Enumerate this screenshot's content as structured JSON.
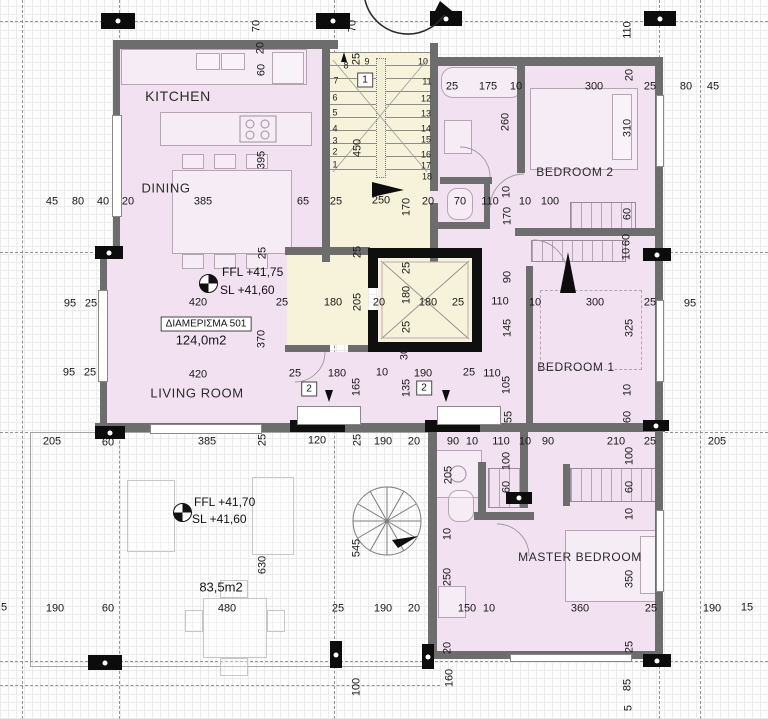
{
  "title": "Floor plan - Apartment 501",
  "colors": {
    "room_fill": "#f2e2f1",
    "stair_fill": "#f7f3da",
    "wall": "#6d6d6d",
    "black": "#0f0f0f",
    "dim_text": "#191919"
  },
  "apartment": {
    "tag": "ΔΙΑΜΕΡΙΣΜΑ 501",
    "area": "124,0m2",
    "ffl": "FFL +41,75",
    "sl": "SL  +41,60"
  },
  "terrace": {
    "area": "83,5m2",
    "ffl": "FFL +41,70",
    "sl": "SL  +41,60"
  },
  "rooms": [
    {
      "name": "KITCHEN",
      "x": 178,
      "y": 96,
      "size": 14
    },
    {
      "name": "DINING",
      "x": 166,
      "y": 188,
      "size": 13
    },
    {
      "name": "LIVING ROOM",
      "x": 197,
      "y": 393,
      "size": 13
    },
    {
      "name": "BEDROOM 2",
      "x": 575,
      "y": 172,
      "size": 12
    },
    {
      "name": "BEDROOM 1",
      "x": 576,
      "y": 367,
      "size": 12
    },
    {
      "name": "MASTER BEDROOM",
      "x": 580,
      "y": 557,
      "size": 12
    }
  ],
  "tags": [
    {
      "label": "1",
      "x": 365,
      "y": 80
    },
    {
      "label": "2",
      "x": 309,
      "y": 389
    },
    {
      "label": "2",
      "x": 424,
      "y": 388
    }
  ],
  "stair_steps": [
    {
      "n": "1",
      "x": 335,
      "y": 165
    },
    {
      "n": "2",
      "x": 335,
      "y": 152
    },
    {
      "n": "3",
      "x": 335,
      "y": 141
    },
    {
      "n": "4",
      "x": 335,
      "y": 129
    },
    {
      "n": "5",
      "x": 335,
      "y": 113
    },
    {
      "n": "6",
      "x": 335,
      "y": 98
    },
    {
      "n": "7",
      "x": 336,
      "y": 81
    },
    {
      "n": "8",
      "x": 346,
      "y": 66
    },
    {
      "n": "9",
      "x": 367,
      "y": 62
    },
    {
      "n": "10",
      "x": 423,
      "y": 62
    },
    {
      "n": "11",
      "x": 427,
      "y": 82
    },
    {
      "n": "12",
      "x": 426,
      "y": 99
    },
    {
      "n": "13",
      "x": 426,
      "y": 114
    },
    {
      "n": "14",
      "x": 426,
      "y": 129
    },
    {
      "n": "15",
      "x": 426,
      "y": 140
    },
    {
      "n": "16",
      "x": 426,
      "y": 155
    },
    {
      "n": "17",
      "x": 426,
      "y": 166
    },
    {
      "n": "18",
      "x": 427,
      "y": 177
    }
  ],
  "dimensions": [
    {
      "t": "70",
      "x": 257,
      "y": 26,
      "v": 1
    },
    {
      "t": "70",
      "x": 353,
      "y": 26,
      "v": 1
    },
    {
      "t": "110",
      "x": 628,
      "y": 30,
      "v": 1
    },
    {
      "t": "20",
      "x": 261,
      "y": 48,
      "v": 1
    },
    {
      "t": "60",
      "x": 262,
      "y": 70,
      "v": 1
    },
    {
      "t": "25",
      "x": 357,
      "y": 59,
      "v": 1
    },
    {
      "t": "450",
      "x": 358,
      "y": 148,
      "v": 1
    },
    {
      "t": "395",
      "x": 262,
      "y": 160,
      "v": 1
    },
    {
      "t": "25",
      "x": 452,
      "y": 87
    },
    {
      "t": "175",
      "x": 488,
      "y": 87
    },
    {
      "t": "10",
      "x": 516,
      "y": 87
    },
    {
      "t": "300",
      "x": 594,
      "y": 87
    },
    {
      "t": "20",
      "x": 630,
      "y": 75,
      "v": 1
    },
    {
      "t": "25",
      "x": 650,
      "y": 87
    },
    {
      "t": "80",
      "x": 686,
      "y": 87
    },
    {
      "t": "45",
      "x": 713,
      "y": 87
    },
    {
      "t": "260",
      "x": 506,
      "y": 122,
      "v": 1
    },
    {
      "t": "310",
      "x": 628,
      "y": 128,
      "v": 1
    },
    {
      "t": "45",
      "x": 52,
      "y": 202
    },
    {
      "t": "80",
      "x": 78,
      "y": 202
    },
    {
      "t": "40",
      "x": 103,
      "y": 202
    },
    {
      "t": "20",
      "x": 128,
      "y": 202
    },
    {
      "t": "385",
      "x": 203,
      "y": 202
    },
    {
      "t": "65",
      "x": 303,
      "y": 202
    },
    {
      "t": "25",
      "x": 336,
      "y": 202
    },
    {
      "t": "250",
      "x": 381,
      "y": 201
    },
    {
      "t": "170",
      "x": 407,
      "y": 207,
      "v": 1
    },
    {
      "t": "20",
      "x": 428,
      "y": 202
    },
    {
      "t": "70",
      "x": 460,
      "y": 202
    },
    {
      "t": "110",
      "x": 490,
      "y": 202
    },
    {
      "t": "10",
      "x": 525,
      "y": 202
    },
    {
      "t": "100",
      "x": 550,
      "y": 202
    },
    {
      "t": "10",
      "x": 507,
      "y": 192,
      "v": 1
    },
    {
      "t": "170",
      "x": 508,
      "y": 216,
      "v": 1
    },
    {
      "t": "60",
      "x": 628,
      "y": 214,
      "v": 1
    },
    {
      "t": "95",
      "x": 70,
      "y": 304
    },
    {
      "t": "25",
      "x": 91,
      "y": 304
    },
    {
      "t": "95",
      "x": 69,
      "y": 373
    },
    {
      "t": "25",
      "x": 90,
      "y": 373
    },
    {
      "t": "420",
      "x": 198,
      "y": 303
    },
    {
      "t": "25",
      "x": 282,
      "y": 303
    },
    {
      "t": "180",
      "x": 333,
      "y": 303
    },
    {
      "t": "205",
      "x": 358,
      "y": 302,
      "v": 1
    },
    {
      "t": "20",
      "x": 379,
      "y": 303
    },
    {
      "t": "180",
      "x": 407,
      "y": 295,
      "v": 1
    },
    {
      "t": "180",
      "x": 428,
      "y": 303
    },
    {
      "t": "25",
      "x": 458,
      "y": 303
    },
    {
      "t": "110",
      "x": 500,
      "y": 302
    },
    {
      "t": "10",
      "x": 535,
      "y": 303
    },
    {
      "t": "300",
      "x": 595,
      "y": 303
    },
    {
      "t": "25",
      "x": 650,
      "y": 303
    },
    {
      "t": "95",
      "x": 690,
      "y": 304
    },
    {
      "t": "25",
      "x": 263,
      "y": 253,
      "v": 1
    },
    {
      "t": "25",
      "x": 358,
      "y": 252,
      "v": 1
    },
    {
      "t": "25",
      "x": 407,
      "y": 268,
      "v": 1
    },
    {
      "t": "25",
      "x": 407,
      "y": 327,
      "v": 1
    },
    {
      "t": "30",
      "x": 405,
      "y": 354,
      "v": 1
    },
    {
      "t": "370",
      "x": 262,
      "y": 339,
      "v": 1
    },
    {
      "t": "90",
      "x": 508,
      "y": 277,
      "v": 1
    },
    {
      "t": "145",
      "x": 508,
      "y": 328,
      "v": 1
    },
    {
      "t": "325",
      "x": 630,
      "y": 328,
      "v": 1
    },
    {
      "t": "60",
      "x": 627,
      "y": 240,
      "v": 1
    },
    {
      "t": "10",
      "x": 627,
      "y": 254,
      "v": 1
    },
    {
      "t": "420",
      "x": 198,
      "y": 375
    },
    {
      "t": "25",
      "x": 295,
      "y": 374
    },
    {
      "t": "180",
      "x": 337,
      "y": 374
    },
    {
      "t": "10",
      "x": 382,
      "y": 373
    },
    {
      "t": "190",
      "x": 423,
      "y": 374
    },
    {
      "t": "25",
      "x": 469,
      "y": 373
    },
    {
      "t": "110",
      "x": 492,
      "y": 374
    },
    {
      "t": "165",
      "x": 357,
      "y": 387,
      "v": 1
    },
    {
      "t": "135",
      "x": 407,
      "y": 388,
      "v": 1
    },
    {
      "t": "105",
      "x": 507,
      "y": 385,
      "v": 1
    },
    {
      "t": "55",
      "x": 509,
      "y": 417,
      "v": 1
    },
    {
      "t": "10",
      "x": 628,
      "y": 390,
      "v": 1
    },
    {
      "t": "60",
      "x": 628,
      "y": 417,
      "v": 1
    },
    {
      "t": "205",
      "x": 52,
      "y": 442
    },
    {
      "t": "60",
      "x": 108,
      "y": 443
    },
    {
      "t": "385",
      "x": 207,
      "y": 442
    },
    {
      "t": "25",
      "x": 263,
      "y": 440,
      "v": 1
    },
    {
      "t": "120",
      "x": 317,
      "y": 441
    },
    {
      "t": "25",
      "x": 358,
      "y": 440,
      "v": 1
    },
    {
      "t": "190",
      "x": 383,
      "y": 442
    },
    {
      "t": "20",
      "x": 414,
      "y": 442
    },
    {
      "t": "90",
      "x": 453,
      "y": 442
    },
    {
      "t": "10",
      "x": 472,
      "y": 442
    },
    {
      "t": "110",
      "x": 501,
      "y": 442
    },
    {
      "t": "10",
      "x": 525,
      "y": 442
    },
    {
      "t": "90",
      "x": 548,
      "y": 442
    },
    {
      "t": "210",
      "x": 616,
      "y": 442
    },
    {
      "t": "25",
      "x": 650,
      "y": 442
    },
    {
      "t": "205",
      "x": 717,
      "y": 442
    },
    {
      "t": "205",
      "x": 449,
      "y": 475,
      "v": 1
    },
    {
      "t": "100",
      "x": 507,
      "y": 461,
      "v": 1
    },
    {
      "t": "60",
      "x": 507,
      "y": 487,
      "v": 1
    },
    {
      "t": "100",
      "x": 630,
      "y": 456,
      "v": 1
    },
    {
      "t": "60",
      "x": 630,
      "y": 487,
      "v": 1
    },
    {
      "t": "10",
      "x": 630,
      "y": 514,
      "v": 1
    },
    {
      "t": "10",
      "x": 448,
      "y": 534,
      "v": 1
    },
    {
      "t": "250",
      "x": 448,
      "y": 577,
      "v": 1
    },
    {
      "t": "350",
      "x": 630,
      "y": 579,
      "v": 1
    },
    {
      "t": "25",
      "x": 630,
      "y": 647,
      "v": 1
    },
    {
      "t": "630",
      "x": 263,
      "y": 565,
      "v": 1
    },
    {
      "t": "545",
      "x": 357,
      "y": 548,
      "v": 1
    },
    {
      "t": "5",
      "x": 4,
      "y": 608
    },
    {
      "t": "190",
      "x": 55,
      "y": 609
    },
    {
      "t": "60",
      "x": 108,
      "y": 609
    },
    {
      "t": "480",
      "x": 227,
      "y": 609
    },
    {
      "t": "25",
      "x": 338,
      "y": 609
    },
    {
      "t": "190",
      "x": 383,
      "y": 609
    },
    {
      "t": "20",
      "x": 414,
      "y": 609
    },
    {
      "t": "150",
      "x": 467,
      "y": 609
    },
    {
      "t": "10",
      "x": 489,
      "y": 609
    },
    {
      "t": "360",
      "x": 580,
      "y": 609
    },
    {
      "t": "25",
      "x": 651,
      "y": 609
    },
    {
      "t": "190",
      "x": 712,
      "y": 609
    },
    {
      "t": "15",
      "x": 747,
      "y": 608
    },
    {
      "t": "100",
      "x": 357,
      "y": 687,
      "v": 1
    },
    {
      "t": "20",
      "x": 448,
      "y": 648,
      "v": 1
    },
    {
      "t": "160",
      "x": 450,
      "y": 678,
      "v": 1
    },
    {
      "t": "85",
      "x": 628,
      "y": 685,
      "v": 1
    },
    {
      "t": "5",
      "x": 629,
      "y": 708,
      "v": 1
    }
  ]
}
